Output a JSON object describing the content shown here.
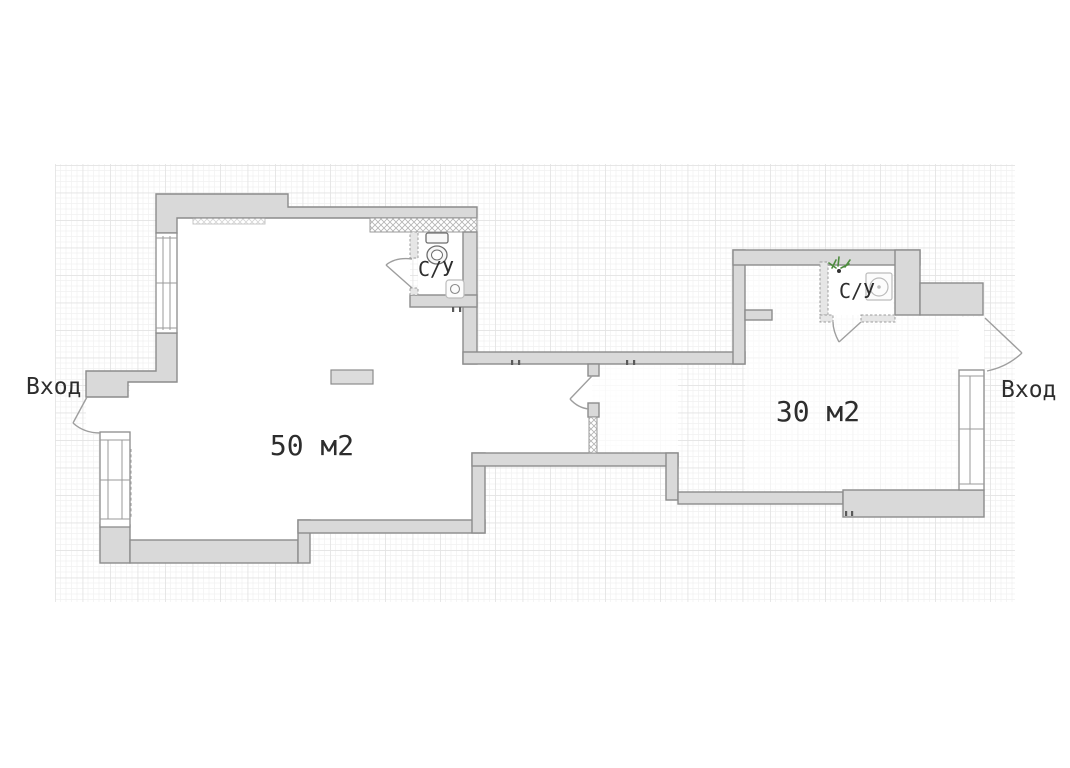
{
  "plan": {
    "type": "floor-plan",
    "rooms": [
      {
        "id": "left-room",
        "area_label": "50 м2"
      },
      {
        "id": "right-room",
        "area_label": "30 м2"
      }
    ],
    "bathrooms": [
      {
        "id": "left-bathroom",
        "label": "С/У",
        "fixtures": [
          "toilet-icon",
          "sink-icon"
        ]
      },
      {
        "id": "right-bathroom",
        "label": "С/У",
        "fixtures": [
          "plant-icon",
          "washer-icon"
        ]
      }
    ],
    "entrances": [
      {
        "id": "left-entrance",
        "label": "Вход"
      },
      {
        "id": "right-entrance",
        "label": "Вход"
      }
    ],
    "colors": {
      "background": "#ffffff",
      "wall_fill": "#d9d9d9",
      "wall_stroke": "#8c8c8c",
      "grid_minor": "#f1f1f1",
      "grid_major": "#e3e3e3",
      "label_text": "#2d2d2d",
      "plant_green": "#4e8c3f"
    }
  }
}
